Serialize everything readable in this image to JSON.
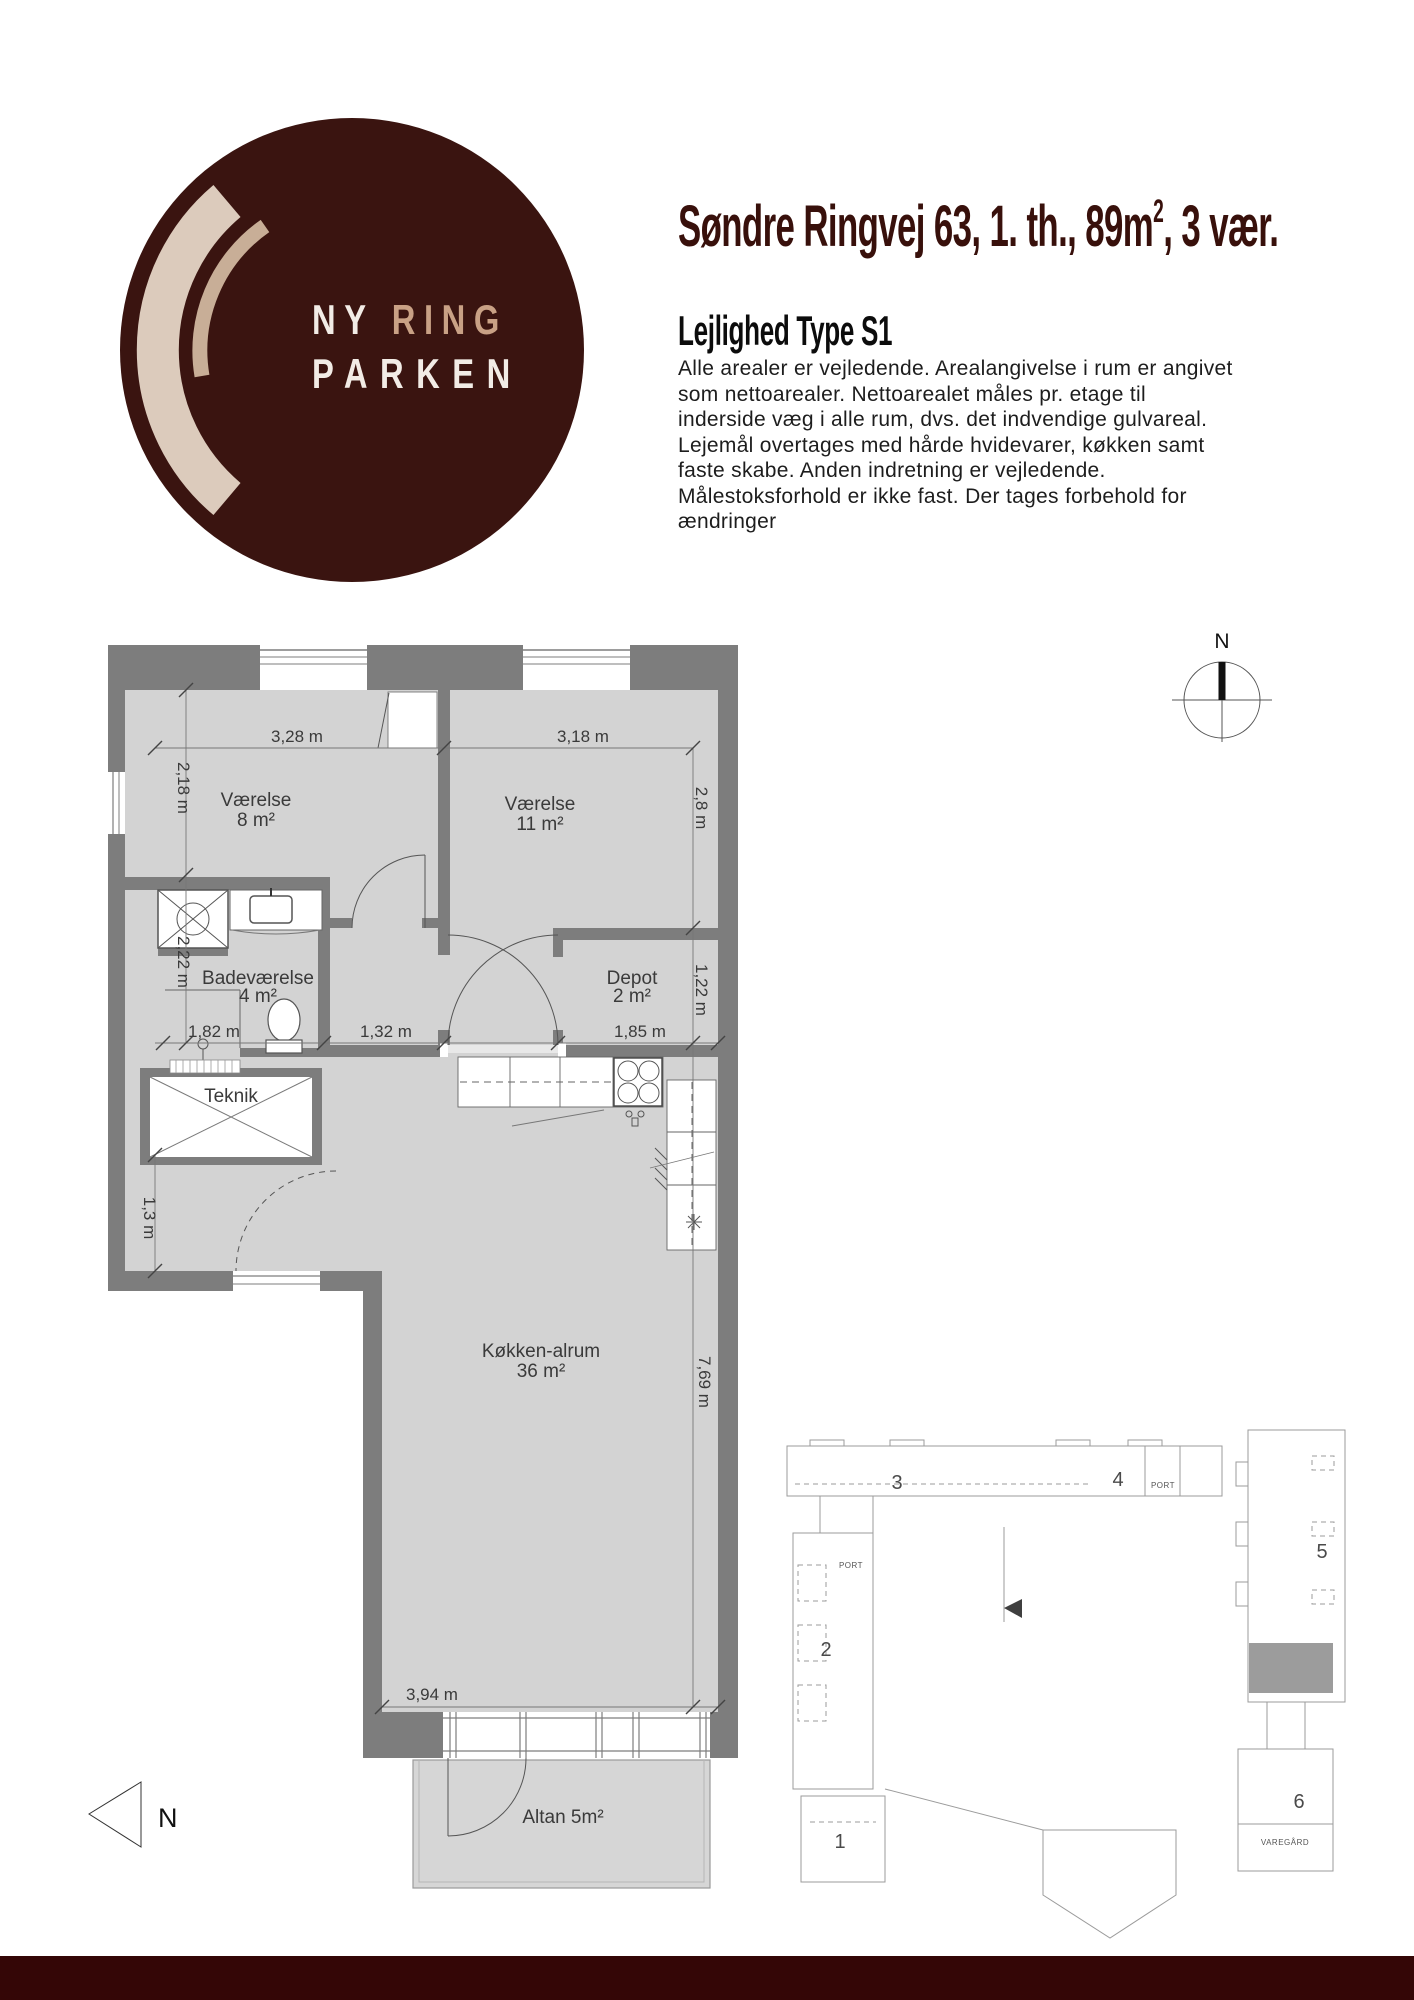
{
  "page": {
    "background": "#ffffff",
    "footer_color": "#340606",
    "accent_color": "#38100b"
  },
  "logo": {
    "line1_part1": "NY ",
    "line1_part2": "RING",
    "line2": "PARKEN",
    "circle_color": "#3a1410",
    "ring_outer_color": "#dccbbc",
    "ring_inner_color": "#c8ae97",
    "text_white": "#f2ece6",
    "text_tan": "#c9a185"
  },
  "header": {
    "title_pre": "Søndre Ringvej 63, 1. th., 89m",
    "title_sup": "2",
    "title_post": ", 3 vær.",
    "subtitle": "Lejlighed Type S1",
    "paragraph_lines": [
      "Alle arealer er vejledende. Arealangivelse i rum er angivet",
      "som nettoarealer. Nettoarealet måles pr. etage til",
      "inderside væg i alle rum, dvs. det indvendige gulvareal.",
      "Lejemål overtages med hårde hvidevarer, køkken samt",
      "faste skabe. Anden indretning er vejledende.",
      "Målestoksforhold er ikke fast. Der tages forbehold for",
      "ændringer"
    ]
  },
  "floorplan": {
    "wall_color": "#7d7d7d",
    "floor_color": "#d3d3d3",
    "labels": {
      "room1_name": "Værelse",
      "room1_area": "8 m²",
      "room2_name": "Værelse",
      "room2_area": "11 m²",
      "bath_name": "Badeværelse",
      "bath_area": "4 m²",
      "depot_name": "Depot",
      "depot_area": "2 m²",
      "teknik": "Teknik",
      "living_name": "Køkken-alrum",
      "living_area": "36 m²",
      "balcony": "Altan 5m²"
    },
    "dimensions": {
      "room1_width": "3,28 m",
      "room1_height": "2,18 m",
      "room2_width": "3,18 m",
      "room2_height": "2,8 m",
      "bath_height": "2,22 m",
      "bath_width": "1,82 m",
      "hall_width": "1,32 m",
      "depot_width": "1,85 m",
      "depot_height": "1,22 m",
      "entry_height": "1,3 m",
      "living_height": "7,69 m",
      "living_width": "3,94 m"
    },
    "compass_label": "N",
    "north_arrow_label": "N"
  },
  "siteplan": {
    "buildings": [
      "1",
      "2",
      "3",
      "4",
      "5",
      "6"
    ],
    "port_label_top": "PORT",
    "port_label_left": "PORT",
    "varegard_label": "VAREGÅRD",
    "highlight_color": "#9c9c9c"
  }
}
